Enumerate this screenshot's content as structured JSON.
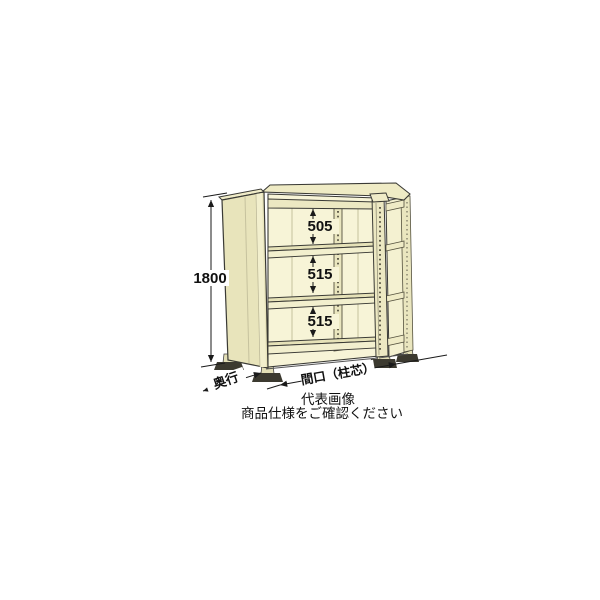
{
  "illustration": {
    "subject": "steel-shelving-unit-3-shelves",
    "height_dim": "1800",
    "shelf_gaps": [
      "505",
      "515",
      "515"
    ],
    "depth_label": "奥行",
    "width_label": "間口（柱芯）",
    "caption_line1": "代表画像",
    "caption_line2": "商品仕様をご確認ください",
    "colors": {
      "panel": "#e8e4bb",
      "panel_interior": "#f7f4d7",
      "panel_highlight": "#f2efcd",
      "outline": "#3a3a35",
      "dimension": "#1a1a1a",
      "background": "#ffffff"
    }
  }
}
